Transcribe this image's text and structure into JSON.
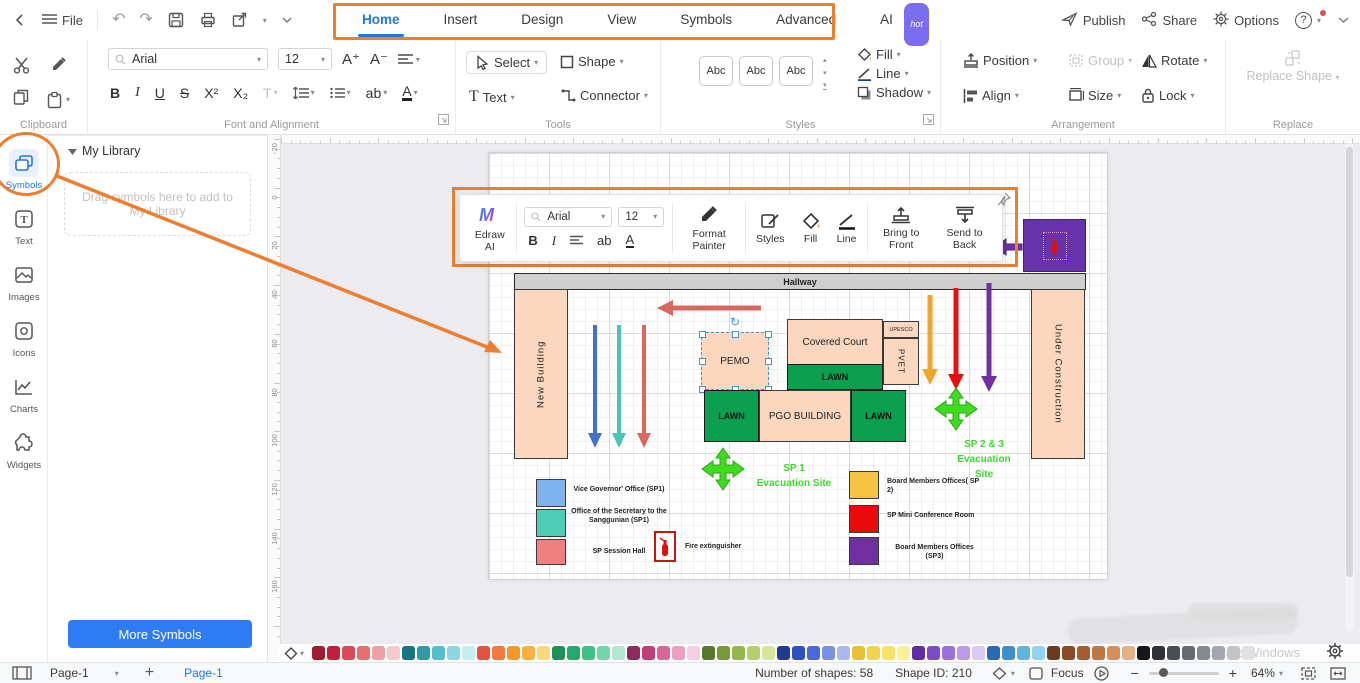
{
  "icons": {
    "caret": "▾",
    "caret_up": "▴",
    "undo": "↶",
    "redo": "↷",
    "rotate_handle": "↻"
  },
  "colors": {
    "accent_orange": "#ee7d2e",
    "active_blue": "#2176e4",
    "lawn_green": "#0ba04f",
    "building_peach": "#fbd7c0",
    "hallway_gray": "#cfcfcf",
    "evac_green": "#3fd92e",
    "purple_room": "#6633ab"
  },
  "topbar": {
    "file": "File",
    "tabs": [
      {
        "label": "Home"
      },
      {
        "label": "Insert"
      },
      {
        "label": "Design"
      },
      {
        "label": "View"
      },
      {
        "label": "Symbols"
      },
      {
        "label": "Advanced"
      },
      {
        "label": "AI",
        "badge": "hot"
      }
    ],
    "publish": "Publish",
    "share": "Share",
    "options": "Options",
    "help": "?"
  },
  "ribbon": {
    "clipboard_label": "Clipboard",
    "font_group_label": "Font and Alignment",
    "font_family": "Arial",
    "font_size": "12",
    "inc": "A⁺",
    "dec": "A⁻",
    "bold": "B",
    "italic": "I",
    "underline": "U",
    "strike": "S",
    "sup": "X²",
    "sub": "X₂",
    "text_color": "T",
    "char_spacing": "ab",
    "font_color": "A",
    "tools_label": "Tools",
    "select": "Select",
    "shape": "Shape",
    "text": "Text",
    "connector": "Connector",
    "styles_label": "Styles",
    "abc": "Abc",
    "fill": "Fill",
    "line": "Line",
    "shadow": "Shadow",
    "arrangement_label": "Arrangement",
    "position": "Position",
    "group": "Group",
    "rotate": "Rotate",
    "align": "Align",
    "size": "Size",
    "lock": "Lock",
    "replace_label": "Replace",
    "replace_shape": "Replace Shape"
  },
  "sidebar": {
    "items": [
      {
        "label": "Symbols"
      },
      {
        "label": "Text"
      },
      {
        "label": "Images"
      },
      {
        "label": "Icons"
      },
      {
        "label": "Charts"
      },
      {
        "label": "Widgets"
      }
    ]
  },
  "library": {
    "title": "My Library",
    "dropzone": "Drag symbols here to add to My Library",
    "more": "More Symbols"
  },
  "float_toolbar": {
    "edraw_ai": "Edraw AI",
    "font_family": "Arial",
    "font_size": "12",
    "bold": "B",
    "italic": "I",
    "char_spacing": "ab",
    "font_color": "A",
    "format_painter": "Format Painter",
    "styles": "Styles",
    "fill": "Fill",
    "line": "Line",
    "bring_front": "Bring to Front",
    "send_back": "Send to Back"
  },
  "ruler": {
    "values": [
      "-20",
      "0",
      "20",
      "40",
      "60",
      "80",
      "100",
      "120",
      "140",
      "160"
    ]
  },
  "diagram": {
    "hallway": "Hallway",
    "new_building": "New Building",
    "under_construction": "Under Construction",
    "pemo": "PEMO",
    "covered_court": "Covered Court",
    "upesco": "UPESCO",
    "pvet": "PVET",
    "lawn": "LAWN",
    "pgo": "PGO BUILDING",
    "sp1_line1": "SP 1",
    "sp1_line2": "Evacuation Site",
    "sp23_line1": "SP 2 & 3",
    "sp23_line2": "Evacuation",
    "sp23_line3": "Site",
    "legend_left": [
      {
        "color": "#7eb3f2",
        "label": "Vice Governor' Office (SP1)"
      },
      {
        "color": "#4ecdb4",
        "label": "Office of the Secretary to the Sanggunian (SP1)"
      },
      {
        "color": "#f08080",
        "label": "SP Session Hall"
      }
    ],
    "fire_label": "Fire extinguisher",
    "legend_right": [
      {
        "color": "#f5c242",
        "label": "Board Members Offices( SP 2)"
      },
      {
        "color": "#ea0a0a",
        "label": "SP Mini Conference Room"
      },
      {
        "color": "#7030a0",
        "label": "Board Members Offices (SP3)"
      }
    ]
  },
  "palette": {
    "colors": [
      "#9e1b30",
      "#c02039",
      "#d9485a",
      "#e57070",
      "#efa0a6",
      "#f6c9cc",
      "#187480",
      "#2f9aa6",
      "#55bec9",
      "#8cd7de",
      "#c6eef2",
      "#e2523d",
      "#ef7a3b",
      "#f4982d",
      "#fab03f",
      "#fdd879",
      "#1d8f59",
      "#27a86b",
      "#3fc188",
      "#72d5ac",
      "#b2e8d2",
      "#8e2a5c",
      "#c13f79",
      "#d96699",
      "#eb9fc0",
      "#f7cfe0",
      "#56792a",
      "#75993a",
      "#95b54d",
      "#b5cf6d",
      "#d5e69c",
      "#1f3a93",
      "#2c50c0",
      "#4a68d6",
      "#7b90e0",
      "#aab9ec",
      "#e8c236",
      "#f0d44c",
      "#f6e268",
      "#fbf098",
      "#5f2ea6",
      "#7d4cc4",
      "#9b70d8",
      "#bb9ae8",
      "#dcc9f4",
      "#2a6ab5",
      "#3f8ed2",
      "#63b2e4",
      "#8fd2f2",
      "#6e3a1f",
      "#8a4a28",
      "#a55c32",
      "#bf7442",
      "#d49058",
      "#e4b184",
      "#14161a",
      "#2e3138",
      "#4a4d55",
      "#666a72",
      "#84888f",
      "#a3a6ac",
      "#c2c4c8",
      "#e0e1e4"
    ]
  },
  "statusbar": {
    "page_select": "Page-1",
    "add_page": "+",
    "page_tab": "Page-1",
    "shapes": "Number of shapes: 58",
    "shape_id": "Shape ID: 210",
    "focus": "Focus",
    "zoom_out": "−",
    "zoom_in": "+",
    "zoom": "64%"
  },
  "watermark": "Activate Windows"
}
